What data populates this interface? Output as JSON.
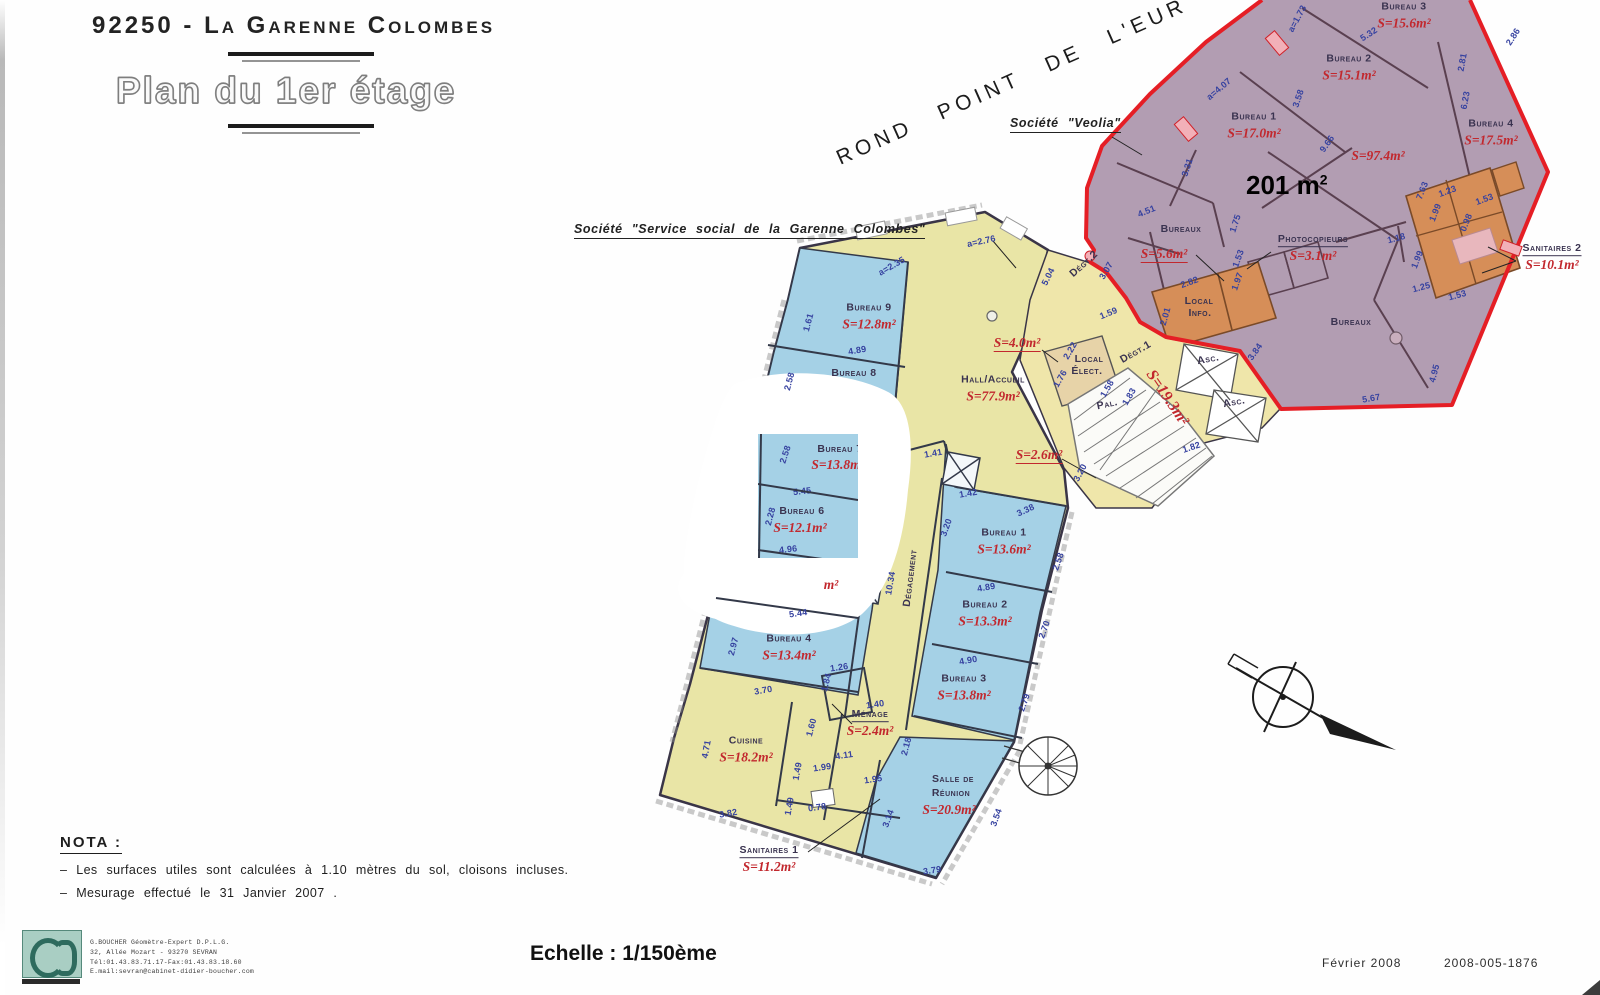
{
  "page": {
    "city_title": "92250 - La Garenne Colombes",
    "plan_title": "Plan du 1er étage"
  },
  "street_label": "ROND POINT DE L'EUR",
  "callouts": {
    "societe_veolia": "Société \"Veolia\"",
    "societe_service": "Société \"Service social de la Garenne Colombes\"",
    "big_area": "201 m",
    "big_area_sup": "2"
  },
  "nota": {
    "title": "NOTA :",
    "lines": [
      "–  Les surfaces utiles sont calculées à 1.10 mètres du sol, cloisons incluses.",
      "–  Mesurage effectué le 31 Janvier 2007 ."
    ]
  },
  "footer": {
    "scale_label": "Echelle : 1/150ème",
    "date": "Février 2008",
    "reference": "2008-005-1876"
  },
  "surveyor": {
    "lines": [
      "G.BOUCHER Géomètre-Expert D.P.L.G.",
      "32, Allée Mozart  -  93270 SEVRAN",
      "Tél:01.43.83.71.17-Fax:01.43.83.18.60",
      "E.mail:sevran@cabinet-didier-boucher.com"
    ]
  },
  "plan": {
    "colors": {
      "purple_zone": "#b29db2",
      "red_boundary": "#e51e25",
      "orange_room": "#d68e58",
      "yellow_zone": "#e9e5a6",
      "corridor_yellow": "#efe6aa",
      "blue_room": "#a5d1e6",
      "tan_room": "#e7d3a8",
      "area_text_red": "#c2282e",
      "dimension_blue": "#3642a0",
      "wall": "#3a3547"
    },
    "room_labels": [
      {
        "name": "Bureau 3",
        "area": "S=15.6m²",
        "x": 1404,
        "y": 14
      },
      {
        "name": "Bureau 2",
        "area": "S=15.1m²",
        "x": 1349,
        "y": 66
      },
      {
        "name": "Bureau 1",
        "area": "S=17.0m²",
        "x": 1254,
        "y": 124
      },
      {
        "name": "Bureau 4",
        "area": "S=17.5m²",
        "x": 1491,
        "y": 131
      },
      {
        "area": "S=97.4m²",
        "x": 1378,
        "y": 156
      },
      {
        "name": "Bureaux",
        "x": 1181,
        "y": 228
      },
      {
        "area": "S=5.6m²",
        "x": 1164,
        "y": 254,
        "au": 1
      },
      {
        "name": "Photocopieurs",
        "area": "S=3.1m²",
        "x": 1313,
        "y": 247,
        "nu": 1
      },
      {
        "name": "Local",
        "x": 1199,
        "y": 300
      },
      {
        "name": "Info.",
        "x": 1200,
        "y": 312
      },
      {
        "name": "Bureaux",
        "x": 1351,
        "y": 321
      },
      {
        "name": "Sanitaires 2",
        "area": "S=10.1m²",
        "x": 1552,
        "y": 256,
        "nu": 1
      },
      {
        "name": "Bureau 9",
        "area": "S=12.8m²",
        "x": 869,
        "y": 315
      },
      {
        "name": "Bureau 8",
        "x": 854,
        "y": 372
      },
      {
        "area": "m²",
        "x": 831,
        "y": 585
      },
      {
        "name": "Bureau 4",
        "area": "S=13.4m²",
        "x": 789,
        "y": 646
      },
      {
        "name": "Hall/Accueil",
        "area": "S=77.9m²",
        "x": 993,
        "y": 387
      },
      {
        "area": "S=4.0m²",
        "x": 1017,
        "y": 343,
        "au": 1
      },
      {
        "name": "Local",
        "x": 1089,
        "y": 358
      },
      {
        "name": "Élect.",
        "x": 1087,
        "y": 370
      },
      {
        "name": "Dégt.2",
        "x": 1083,
        "y": 263,
        "rot": -42
      },
      {
        "name": "Dégt.1",
        "x": 1135,
        "y": 351,
        "rot": -30
      },
      {
        "area": "S=19.3m²",
        "x": 1167,
        "y": 398,
        "rot": 56,
        "big": 1
      },
      {
        "name": "Pal.",
        "x": 1107,
        "y": 403,
        "rot": -12
      },
      {
        "area": "S=2.6m²",
        "x": 1039,
        "y": 455,
        "au": 1
      },
      {
        "name": "Asc.",
        "x": 1208,
        "y": 358,
        "rot": -10
      },
      {
        "name": "Asc.",
        "x": 1234,
        "y": 401,
        "rot": -10
      },
      {
        "name": "Dégagement",
        "x": 909,
        "y": 578,
        "rot": -83
      },
      {
        "name": "Bureau 1",
        "area": "S=13.6m²",
        "x": 1004,
        "y": 540
      },
      {
        "name": "Bureau 2",
        "area": "S=13.3m²",
        "x": 985,
        "y": 612
      },
      {
        "name": "Bureau 3",
        "area": "S=13.8m²",
        "x": 964,
        "y": 686
      },
      {
        "name": "Ménage",
        "area": "S=2.4m²",
        "x": 870,
        "y": 722,
        "nu": 1
      },
      {
        "name": "Cuisine",
        "area": "S=18.2m²",
        "x": 746,
        "y": 748
      },
      {
        "name": "Salle de",
        "x": 953,
        "y": 778
      },
      {
        "name": "Réunion",
        "x": 951,
        "y": 792
      },
      {
        "area": "S=20.9m²",
        "x": 949,
        "y": 810
      },
      {
        "name": "Sanitaires 1",
        "area": "S=11.2m²",
        "x": 769,
        "y": 858,
        "nu": 1
      }
    ],
    "window_labels": [
      {
        "name": "Bureau 7",
        "x": 82,
        "y": 14
      },
      {
        "area": "S=13.8m²",
        "x": 80,
        "y": 31
      },
      {
        "dim": "5.45",
        "x": 44,
        "y": 56,
        "rot": -6
      },
      {
        "name": "Bureau 6",
        "x": 44,
        "y": 76
      },
      {
        "area": "S=12.1m²",
        "x": 42,
        "y": 94
      },
      {
        "dim": "4.96",
        "x": 30,
        "y": 114,
        "rot": -6
      },
      {
        "dim": "2.58",
        "x": 26,
        "y": 20,
        "rot": -72
      },
      {
        "dim": "2.28",
        "x": 11,
        "y": 82,
        "rot": -75
      }
    ],
    "dimensions": [
      {
        "t": "a=1.73",
        "x": 1296,
        "y": 18,
        "r": -62
      },
      {
        "t": "5.32",
        "x": 1368,
        "y": 33,
        "r": -33
      },
      {
        "t": "2.86",
        "x": 1512,
        "y": 36,
        "r": -57
      },
      {
        "t": "2.81",
        "x": 1461,
        "y": 62,
        "r": -80
      },
      {
        "t": "a=4.07",
        "x": 1218,
        "y": 88,
        "r": -40
      },
      {
        "t": "3.58",
        "x": 1297,
        "y": 98,
        "r": -72
      },
      {
        "t": "6.23",
        "x": 1464,
        "y": 100,
        "r": -80
      },
      {
        "t": "9.66",
        "x": 1326,
        "y": 143,
        "r": -55
      },
      {
        "t": "3.31",
        "x": 1186,
        "y": 167,
        "r": -72
      },
      {
        "t": "4.51",
        "x": 1146,
        "y": 210,
        "r": -22
      },
      {
        "t": "1.75",
        "x": 1234,
        "y": 223,
        "r": -72
      },
      {
        "t": "7.63",
        "x": 1421,
        "y": 190,
        "r": -68
      },
      {
        "t": "1.23",
        "x": 1447,
        "y": 190,
        "r": -20
      },
      {
        "t": "1.53",
        "x": 1484,
        "y": 198,
        "r": -20
      },
      {
        "t": "1.99",
        "x": 1434,
        "y": 212,
        "r": -68
      },
      {
        "t": "0.98",
        "x": 1465,
        "y": 222,
        "r": -68
      },
      {
        "t": "1.18",
        "x": 1396,
        "y": 237,
        "r": -15
      },
      {
        "t": "2.82",
        "x": 1189,
        "y": 281,
        "r": -20
      },
      {
        "t": "1.53",
        "x": 1237,
        "y": 258,
        "r": -70
      },
      {
        "t": "1.97",
        "x": 1236,
        "y": 281,
        "r": -70
      },
      {
        "t": "2.01",
        "x": 1164,
        "y": 316,
        "r": -74
      },
      {
        "t": "1.99",
        "x": 1416,
        "y": 259,
        "r": -68
      },
      {
        "t": "1.25",
        "x": 1421,
        "y": 286,
        "r": -15
      },
      {
        "t": "1.53",
        "x": 1457,
        "y": 294,
        "r": -15
      },
      {
        "t": "3.84",
        "x": 1254,
        "y": 351,
        "r": -55
      },
      {
        "t": "4.95",
        "x": 1433,
        "y": 373,
        "r": -75
      },
      {
        "t": "5.67",
        "x": 1371,
        "y": 397,
        "r": -10
      },
      {
        "t": "5.04",
        "x": 1047,
        "y": 276,
        "r": -63
      },
      {
        "t": "3.07",
        "x": 1105,
        "y": 270,
        "r": -60
      },
      {
        "t": "1.59",
        "x": 1108,
        "y": 312,
        "r": -22
      },
      {
        "t": "2.22",
        "x": 1069,
        "y": 350,
        "r": -60
      },
      {
        "t": "1.76",
        "x": 1059,
        "y": 378,
        "r": -60
      },
      {
        "t": "1.58",
        "x": 1106,
        "y": 388,
        "r": -60
      },
      {
        "t": "1.83",
        "x": 1128,
        "y": 396,
        "r": -60
      },
      {
        "t": "3.20",
        "x": 1079,
        "y": 472,
        "r": -62
      },
      {
        "t": "1.82",
        "x": 1191,
        "y": 446,
        "r": -18
      },
      {
        "t": "a=2.35",
        "x": 891,
        "y": 265,
        "r": -30
      },
      {
        "t": "a=2.76",
        "x": 981,
        "y": 240,
        "r": -12
      },
      {
        "t": "1.61",
        "x": 807,
        "y": 322,
        "r": -75
      },
      {
        "t": "4.89",
        "x": 857,
        "y": 349,
        "r": -10
      },
      {
        "t": "2.58",
        "x": 788,
        "y": 381,
        "r": -75
      },
      {
        "t": "5.44",
        "x": 798,
        "y": 612,
        "r": -8
      },
      {
        "t": "2.97",
        "x": 732,
        "y": 646,
        "r": -75
      },
      {
        "t": "3.70",
        "x": 763,
        "y": 689,
        "r": -10
      },
      {
        "t": "1.26",
        "x": 839,
        "y": 666,
        "r": -8
      },
      {
        "t": "1.84",
        "x": 825,
        "y": 682,
        "r": -75
      },
      {
        "t": "1.40",
        "x": 875,
        "y": 703,
        "r": -8
      },
      {
        "t": "1.41",
        "x": 933,
        "y": 452,
        "r": -10
      },
      {
        "t": "1.42",
        "x": 968,
        "y": 492,
        "r": -10
      },
      {
        "t": "3.38",
        "x": 1025,
        "y": 509,
        "r": -25
      },
      {
        "t": "3.20",
        "x": 945,
        "y": 527,
        "r": -70
      },
      {
        "t": "10.34",
        "x": 889,
        "y": 583,
        "r": -80
      },
      {
        "t": "4.89",
        "x": 986,
        "y": 586,
        "r": -10
      },
      {
        "t": "2.58",
        "x": 1057,
        "y": 561,
        "r": -70
      },
      {
        "t": "2.70",
        "x": 1043,
        "y": 629,
        "r": -70
      },
      {
        "t": "4.90",
        "x": 968,
        "y": 659,
        "r": -10
      },
      {
        "t": "2.79",
        "x": 1023,
        "y": 702,
        "r": -70
      },
      {
        "t": "1.60",
        "x": 810,
        "y": 727,
        "r": -75
      },
      {
        "t": "4.11",
        "x": 844,
        "y": 754,
        "r": -8
      },
      {
        "t": "2.18",
        "x": 905,
        "y": 746,
        "r": -75
      },
      {
        "t": "1.49",
        "x": 796,
        "y": 771,
        "r": -80
      },
      {
        "t": "1.99",
        "x": 822,
        "y": 766,
        "r": -8
      },
      {
        "t": "1.95",
        "x": 873,
        "y": 778,
        "r": -8
      },
      {
        "t": "1.49",
        "x": 788,
        "y": 806,
        "r": -80
      },
      {
        "t": "0.78",
        "x": 817,
        "y": 806,
        "r": -8
      },
      {
        "t": "3.14",
        "x": 887,
        "y": 818,
        "r": -70
      },
      {
        "t": "3.82",
        "x": 728,
        "y": 812,
        "r": -10
      },
      {
        "t": "4.71",
        "x": 705,
        "y": 749,
        "r": -80
      },
      {
        "t": "3.79",
        "x": 932,
        "y": 869,
        "r": -8
      },
      {
        "t": "3.54",
        "x": 995,
        "y": 817,
        "r": -70
      }
    ]
  }
}
